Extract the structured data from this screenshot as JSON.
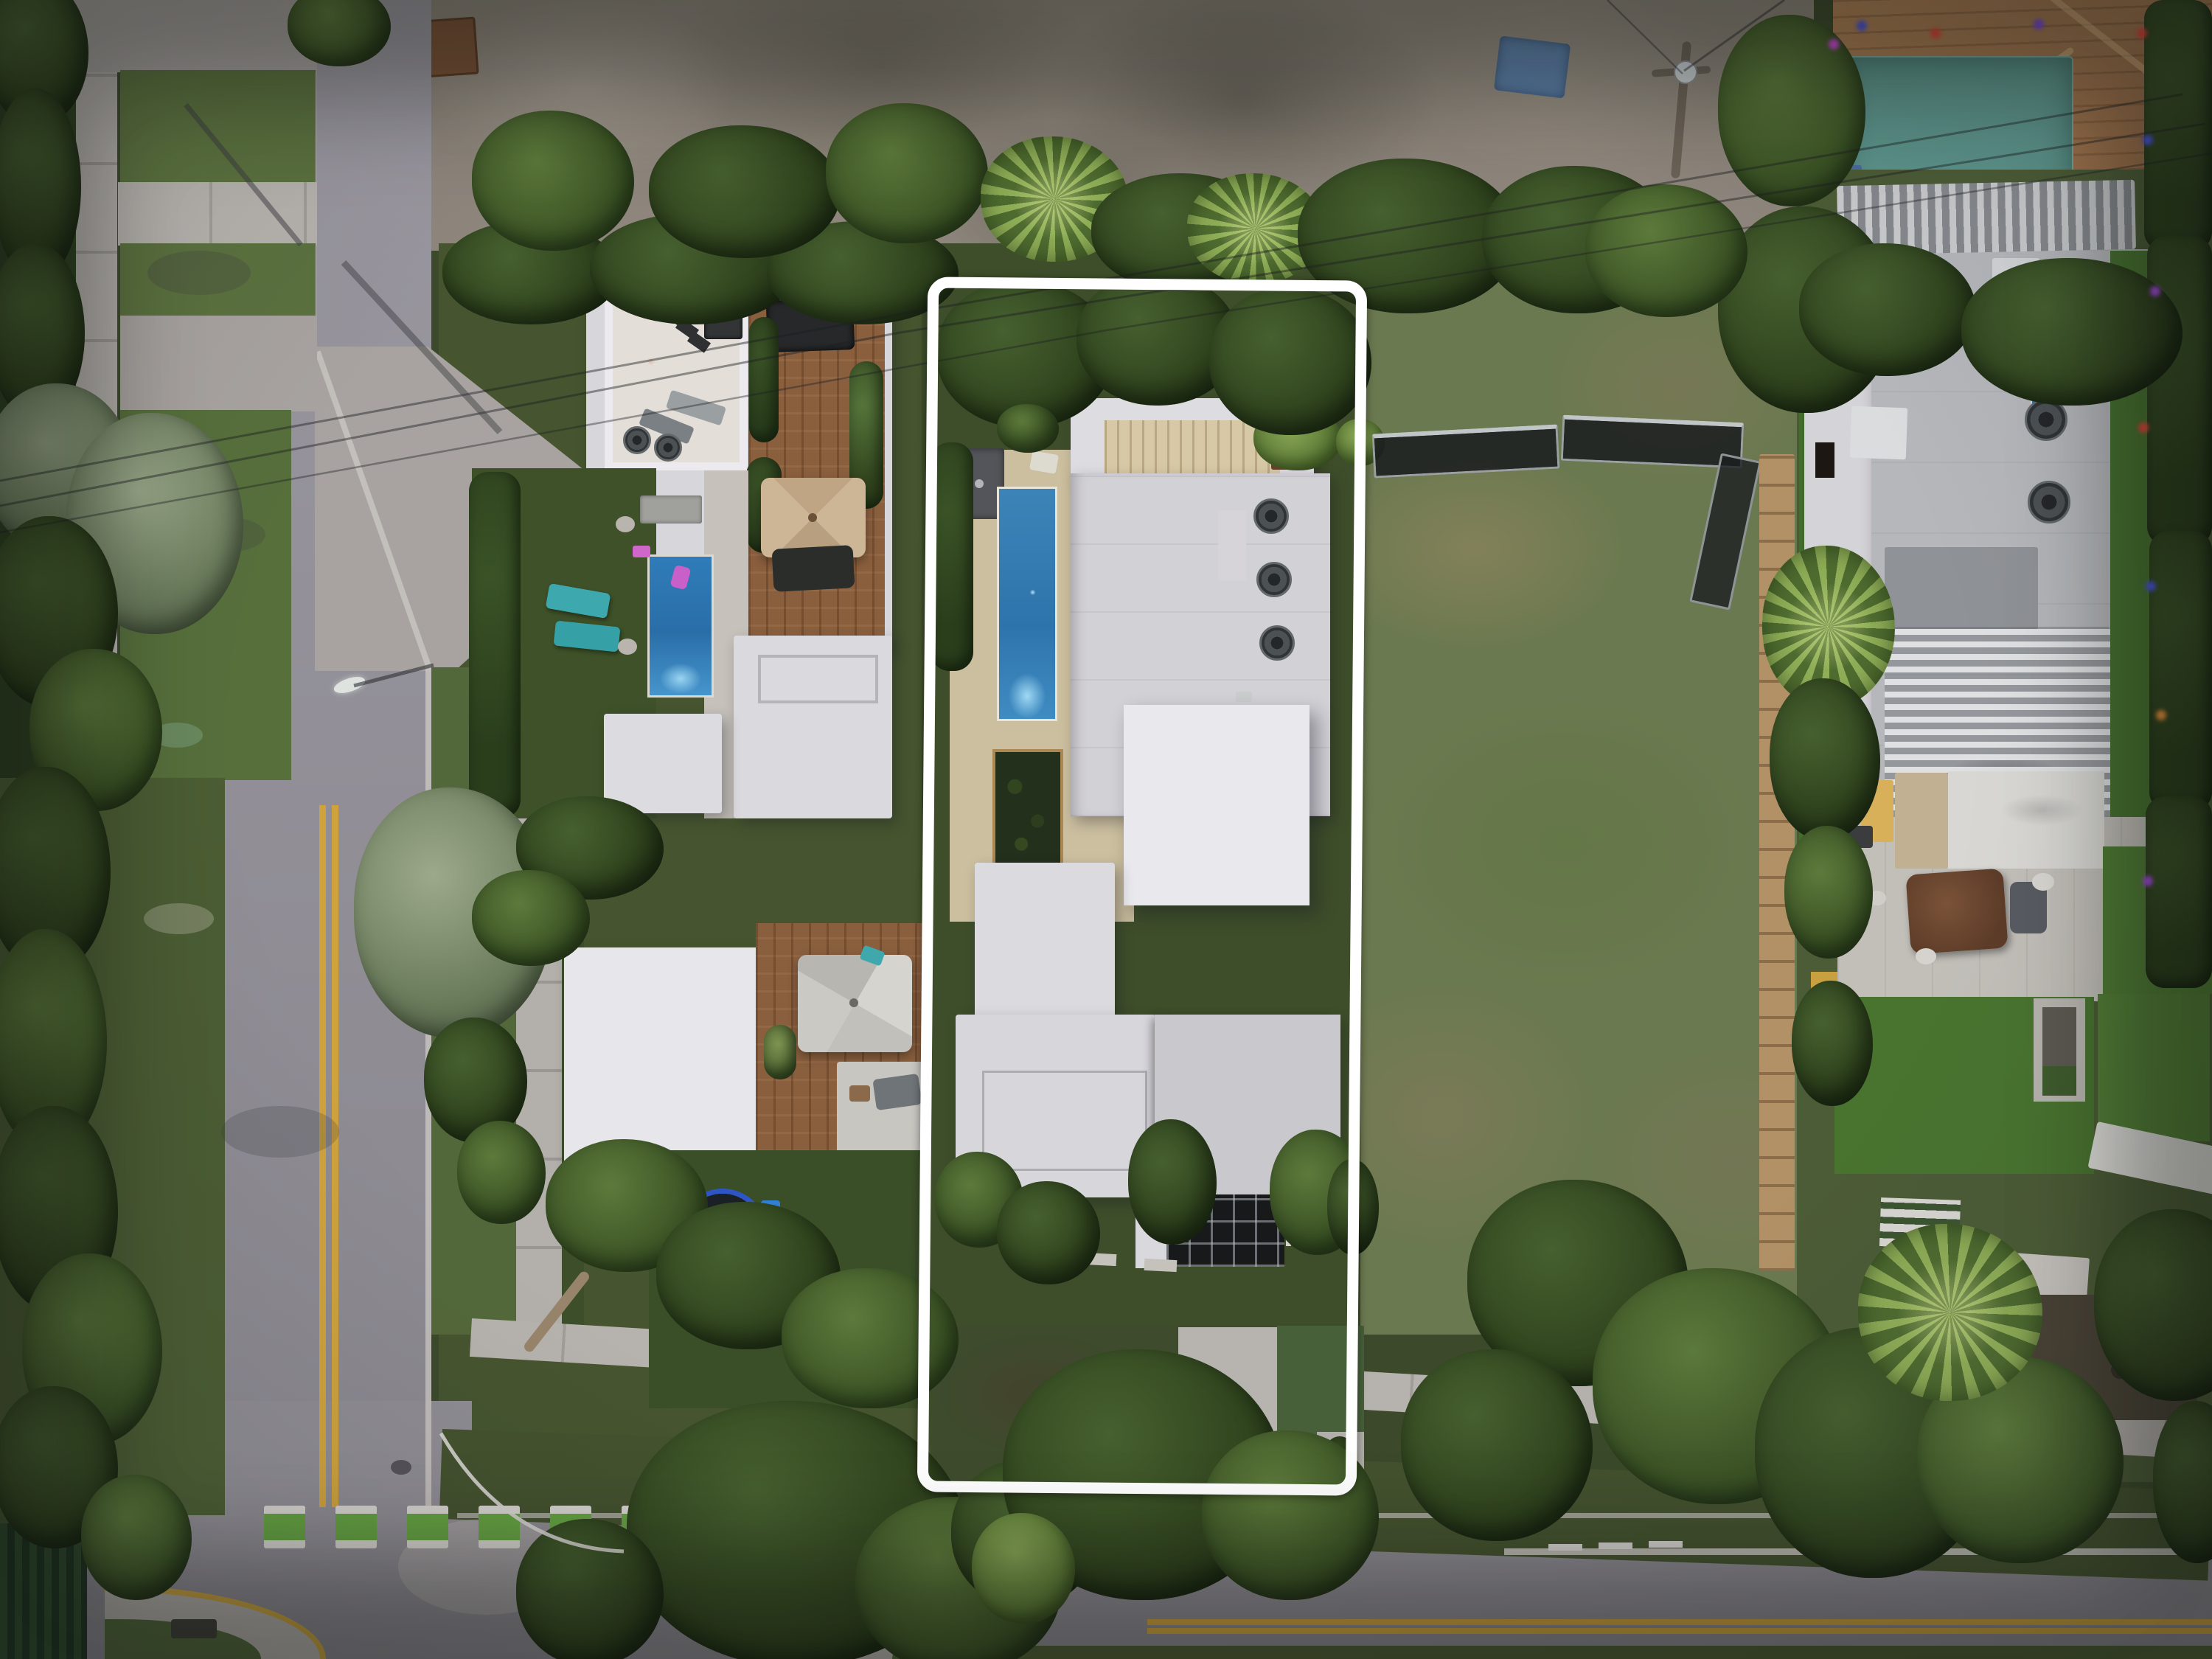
{
  "page": {
    "type": "aerial-photograph",
    "title": "Top-down drone photo of a residential block at dusk with one lot outlined"
  },
  "overlay": {
    "property_outline": {
      "label": "Featured property boundary",
      "color": "#ffffff",
      "shape": "rounded rectangle",
      "title": "Property boundary highlight"
    }
  },
  "scene": {
    "time_of_day": "dusk",
    "lots": [
      {
        "name": "left-modern-house",
        "features": [
          "white flat roofs",
          "rooftop terrace with bar seating and two AC fans",
          "wood roof deck with tan umbrella",
          "blue swimming pool with two teal loungers and pink float",
          "second wood deck with gray umbrella",
          "backyard turf with trampoline"
        ]
      },
      {
        "name": "featured-house",
        "features": [
          "stacked white flat-roof volumes",
          "lap pool on tan deck",
          "three rooftop AC units",
          "cream louvered pergola",
          "interior courtyard garden with bronze trim",
          "dark glass entry gate",
          "front driveway"
        ]
      },
      {
        "name": "vacant-lot",
        "features": [
          "patchy grass and dirt",
          "construction mesh fencing",
          "wooden plank path"
        ]
      },
      {
        "name": "right-modern-house",
        "features": [
          "gray roof deck with three AC units",
          "two louvered pergolas",
          "artificial-turf roof terraces",
          "terrace with brown daybed and gray ottoman",
          "colored string lights on hedge"
        ]
      },
      {
        "name": "tile-roof-house",
        "features": [
          "terracotta shingle roof",
          "teal awning",
          "blue tarp"
        ]
      },
      {
        "name": "construction-site",
        "features": [
          "graded dirt",
          "rubble piles",
          "blue tarp",
          "brown dumpster"
        ]
      }
    ],
    "streets": [
      {
        "name": "side-street-vertical",
        "markings": [
          "double yellow center line",
          "white curb lines",
          "concrete crossings",
          "street light"
        ]
      },
      {
        "name": "main-street-horizontal",
        "markings": [
          "green and white bike crosswalk",
          "double yellow center line",
          "white lane line and dashes",
          "yellow-curbed corner islands",
          "white turn guide arc"
        ]
      }
    ],
    "palette": {
      "asphalt": "#94919a",
      "concrete": "#b3afab",
      "white_roof": "#e7e6ea",
      "gray_roof": "#b5b7bb",
      "tan_deck": "#ccbf9f",
      "wood_deck": "#8a5f3e",
      "pool_blue": "#2f7cb8",
      "turf_green": "#4f7c34",
      "lawn_green": "#46552f",
      "tree_dark": "#32461f",
      "tree_silver": "#8a9a80",
      "palm_green": "#8fae57",
      "terracotta": "#a97c54",
      "awning_teal": "#5d958c",
      "marking_yellow": "#cfa23c",
      "crosswalk_green": "#65a242",
      "outline_white": "#ffffff"
    },
    "string_light_colors": [
      "#e04438",
      "#4a55e0",
      "#a44ae0",
      "#e8913a",
      "#d44ae0"
    ]
  }
}
